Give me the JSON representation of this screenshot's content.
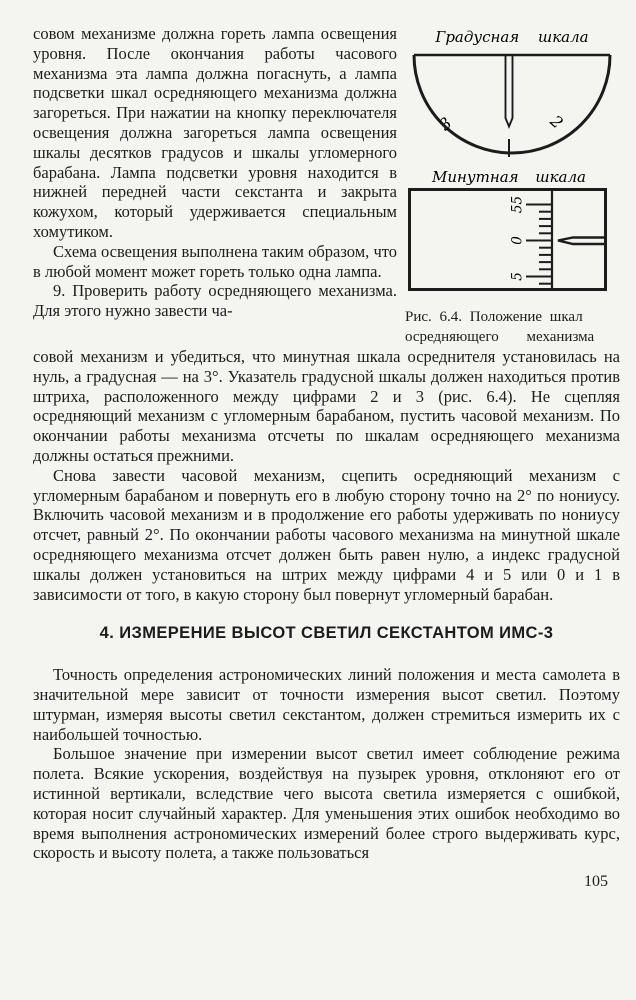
{
  "page": {
    "number": "105",
    "background_color": "#f4f5f1",
    "text_color": "#1c1c1c"
  },
  "left_column": {
    "para_lamp": "совом механизме должна гореть лампа освещения уровня. После окончания работы часового механизма эта лампа должна погаснуть, а лампа подсветки шкал осредняющего механизма должна загореться. При нажатии на кнопку переключателя освещения должна загореться лампа освещения шкалы десятков градусов и шкалы угломерного барабана. Лампа подсветки уровня находится в нижней передней части секстанта и закрыта кожухом, который удерживается специальным хомутиком.",
    "para_scheme": "Схема освещения выполнена таким образом, что в любой момент может гореть только одна лампа.",
    "para_check_start": "9. Проверить работу осредняющего механизма. Для этого нужно завести ча-"
  },
  "figures": {
    "degree_scale": {
      "label": "Градусная шкала",
      "left_numeral": "3",
      "right_numeral": "2"
    },
    "minute_scale": {
      "label": "Минутная шкала",
      "tick_labels": [
        "55",
        "0",
        "5"
      ]
    },
    "caption_line_1": "Рис. 6.4. Положение шкал",
    "caption_line_2": "осредняющего механизма"
  },
  "main": {
    "para_check_cont": "совой механизм и убедиться, что минутная шкала осреднителя установилась на нуль, а градусная — на 3°. Указатель градусной шкалы должен находиться против штриха, расположенного между цифрами 2 и 3 (рис. 6.4). Не сцепляя осредняющий механизм с угломерным барабаном, пустить часовой механизм. По окончании работы механизма отсчеты по шкалам осредняющего механизма должны остаться прежними.",
    "para_again": "Снова завести часовой механизм, сцепить осредняющий механизм с угломерным барабаном и повернуть его в любую сторону точно на 2° по нониусу. Включить часовой механизм и в продолжение его работы удерживать по нониусу отсчет, равный 2°. По окончании работы часового механизма на минутной шкале осредняющего механизма отсчет должен быть равен нулю, а индекс градусной шкалы должен установиться на штрих между цифрами 4 и 5 или 0 и 1 в зависимости от того, в какую сторону был повернут угломерный барабан.",
    "heading": "4. ИЗМЕРЕНИЕ ВЫСОТ СВЕТИЛ СЕКСТАНТОМ ИМС-3",
    "para_accuracy": "Точность определения астрономических линий положения и места самолета в значительной мере зависит от точности измерения высот светил. Поэтому штурман, измеряя высоты светил секстантом, должен стремиться измерить их с наибольшей точностью.",
    "para_flight_mode": "Большое значение при измерении высот светил имеет соблюдение режима полета. Всякие ускорения, воздействуя на пузырек уровня, отклоняют его от истинной вертикали, вследствие чего высота светила измеряется с ошибкой, которая носит случайный характер. Для уменьшения этих ошибок необходимо во время выполнения астрономических измерений более строго выдерживать курс, скорость и высоту полета, а также пользоваться"
  }
}
